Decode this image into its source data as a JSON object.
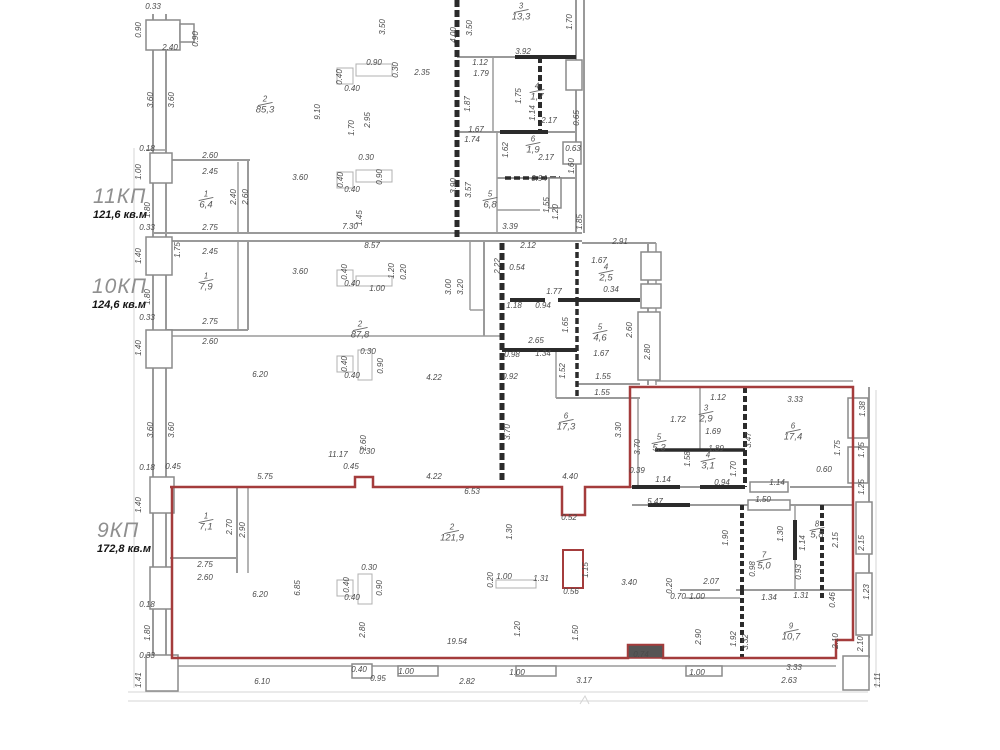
{
  "colors": {
    "unit_outline": "#a43c3c",
    "walls": "#9a9a9a",
    "walls_dark": "#2b2b2b",
    "dim_text": "#4a4a4a"
  },
  "units": [
    {
      "name": "11КП",
      "area": "121,6 кв.м",
      "x": 93,
      "y": 186
    },
    {
      "name": "10КП",
      "area": "124,6 кв.м",
      "x": 92,
      "y": 276
    },
    {
      "name": "9КП",
      "area": "172,8 кв.м",
      "x": 97,
      "y": 520
    }
  ],
  "rooms": [
    {
      "num": "2",
      "area": "85,3",
      "x": 265,
      "y": 105
    },
    {
      "num": "1",
      "area": "6,4",
      "x": 206,
      "y": 200
    },
    {
      "num": "3",
      "area": "13,3",
      "x": 521,
      "y": 12
    },
    {
      "num": "4",
      "area": "1,7",
      "x": 537,
      "y": 92
    },
    {
      "num": "5",
      "area": "6,8",
      "x": 490,
      "y": 200
    },
    {
      "num": "6",
      "area": "1,9",
      "x": 533,
      "y": 145
    },
    {
      "num": "1",
      "area": "7,9",
      "x": 206,
      "y": 282
    },
    {
      "num": "2",
      "area": "87,8",
      "x": 360,
      "y": 330
    },
    {
      "num": "4",
      "area": "2,5",
      "x": 606,
      "y": 273
    },
    {
      "num": "5",
      "area": "4,6",
      "x": 600,
      "y": 333
    },
    {
      "num": "6",
      "area": "17,3",
      "x": 566,
      "y": 422
    },
    {
      "num": "3",
      "area": "2,9",
      "x": 706,
      "y": 414
    },
    {
      "num": "5",
      "area": "5,3",
      "x": 659,
      "y": 443
    },
    {
      "num": "4",
      "area": "3,1",
      "x": 708,
      "y": 461
    },
    {
      "num": "6",
      "area": "17,4",
      "x": 793,
      "y": 432
    },
    {
      "num": "1",
      "area": "7,1",
      "x": 206,
      "y": 522
    },
    {
      "num": "2",
      "area": "121,9",
      "x": 452,
      "y": 533
    },
    {
      "num": "7",
      "area": "5,0",
      "x": 764,
      "y": 561
    },
    {
      "num": "8",
      "area": "5,8",
      "x": 817,
      "y": 530
    },
    {
      "num": "9",
      "area": "10,7",
      "x": 791,
      "y": 632
    }
  ],
  "dimensions": [
    {
      "t": "0.33",
      "x": 153,
      "y": 7
    },
    {
      "t": "0.90",
      "x": 139,
      "y": 30,
      "v": 1
    },
    {
      "t": "0.90",
      "x": 196,
      "y": 39,
      "v": 1
    },
    {
      "t": "2.40",
      "x": 170,
      "y": 48
    },
    {
      "t": "3.60",
      "x": 151,
      "y": 100,
      "v": 1
    },
    {
      "t": "3.60",
      "x": 172,
      "y": 100,
      "v": 1
    },
    {
      "t": "0.18",
      "x": 147,
      "y": 149
    },
    {
      "t": "1.00",
      "x": 139,
      "y": 172,
      "v": 1
    },
    {
      "t": "2.60",
      "x": 210,
      "y": 156
    },
    {
      "t": "2.45",
      "x": 210,
      "y": 172
    },
    {
      "t": "1.80",
      "x": 148,
      "y": 210,
      "v": 1
    },
    {
      "t": "2.40",
      "x": 234,
      "y": 197,
      "v": 1
    },
    {
      "t": "2.60",
      "x": 246,
      "y": 197,
      "v": 1
    },
    {
      "t": "3.60",
      "x": 300,
      "y": 178
    },
    {
      "t": "0.33",
      "x": 147,
      "y": 228
    },
    {
      "t": "2.75",
      "x": 210,
      "y": 228
    },
    {
      "t": "7.30",
      "x": 350,
      "y": 227
    },
    {
      "t": "1.40",
      "x": 139,
      "y": 256,
      "v": 1
    },
    {
      "t": "1.75",
      "x": 178,
      "y": 250,
      "v": 1
    },
    {
      "t": "2.45",
      "x": 210,
      "y": 252
    },
    {
      "t": "8.57",
      "x": 372,
      "y": 246
    },
    {
      "t": "3.60",
      "x": 300,
      "y": 272
    },
    {
      "t": "1.80",
      "x": 148,
      "y": 297,
      "v": 1
    },
    {
      "t": "0.33",
      "x": 147,
      "y": 318
    },
    {
      "t": "2.75",
      "x": 210,
      "y": 322
    },
    {
      "t": "2.60",
      "x": 210,
      "y": 342
    },
    {
      "t": "1.40",
      "x": 139,
      "y": 348,
      "v": 1
    },
    {
      "t": "3.60",
      "x": 151,
      "y": 430,
      "v": 1
    },
    {
      "t": "3.60",
      "x": 172,
      "y": 430,
      "v": 1
    },
    {
      "t": "6.20",
      "x": 260,
      "y": 375
    },
    {
      "t": "0.18",
      "x": 147,
      "y": 468
    },
    {
      "t": "0.45",
      "x": 173,
      "y": 467
    },
    {
      "t": "5.75",
      "x": 265,
      "y": 477
    },
    {
      "t": "1.40",
      "x": 139,
      "y": 505,
      "v": 1
    },
    {
      "t": "2.75",
      "x": 205,
      "y": 565
    },
    {
      "t": "2.60",
      "x": 205,
      "y": 578
    },
    {
      "t": "6.20",
      "x": 260,
      "y": 595
    },
    {
      "t": "6.85",
      "x": 298,
      "y": 588,
      "v": 1
    },
    {
      "t": "0.18",
      "x": 147,
      "y": 605
    },
    {
      "t": "1.80",
      "x": 148,
      "y": 633,
      "v": 1
    },
    {
      "t": "0.33",
      "x": 147,
      "y": 656
    },
    {
      "t": "1.41",
      "x": 139,
      "y": 680,
      "v": 1
    },
    {
      "t": "6.10",
      "x": 262,
      "y": 682
    },
    {
      "t": "3.50",
      "x": 383,
      "y": 27,
      "v": 1
    },
    {
      "t": "0.40",
      "x": 340,
      "y": 77,
      "v": 1
    },
    {
      "t": "0.90",
      "x": 374,
      "y": 63
    },
    {
      "t": "0.40",
      "x": 352,
      "y": 89
    },
    {
      "t": "0.30",
      "x": 396,
      "y": 70,
      "v": 1
    },
    {
      "t": "2.35",
      "x": 422,
      "y": 73
    },
    {
      "t": "9.10",
      "x": 318,
      "y": 112,
      "v": 1
    },
    {
      "t": "1.70",
      "x": 352,
      "y": 128,
      "v": 1
    },
    {
      "t": "2.95",
      "x": 368,
      "y": 120,
      "v": 1
    },
    {
      "t": "0.30",
      "x": 366,
      "y": 158
    },
    {
      "t": "0.40",
      "x": 341,
      "y": 180,
      "v": 1
    },
    {
      "t": "0.90",
      "x": 380,
      "y": 177,
      "v": 1
    },
    {
      "t": "0.40",
      "x": 352,
      "y": 190
    },
    {
      "t": "1.45",
      "x": 360,
      "y": 218,
      "v": 1
    },
    {
      "t": "4.00",
      "x": 454,
      "y": 35,
      "v": 1
    },
    {
      "t": "3.50",
      "x": 470,
      "y": 28,
      "v": 1
    },
    {
      "t": "1.70",
      "x": 570,
      "y": 22,
      "v": 1
    },
    {
      "t": "3.92",
      "x": 523,
      "y": 52
    },
    {
      "t": "1.12",
      "x": 480,
      "y": 63
    },
    {
      "t": "1.79",
      "x": 481,
      "y": 74
    },
    {
      "t": "1.75",
      "x": 519,
      "y": 96,
      "v": 1
    },
    {
      "t": "1.14",
      "x": 533,
      "y": 113,
      "v": 1
    },
    {
      "t": "1.87",
      "x": 468,
      "y": 104,
      "v": 1
    },
    {
      "t": "2.17",
      "x": 549,
      "y": 121
    },
    {
      "t": "1.67",
      "x": 476,
      "y": 130
    },
    {
      "t": "1.74",
      "x": 472,
      "y": 140
    },
    {
      "t": "0.65",
      "x": 577,
      "y": 118,
      "v": 1
    },
    {
      "t": "1.62",
      "x": 506,
      "y": 150,
      "v": 1
    },
    {
      "t": "2.17",
      "x": 546,
      "y": 158
    },
    {
      "t": "0.63",
      "x": 573,
      "y": 149
    },
    {
      "t": "1.60",
      "x": 572,
      "y": 166,
      "v": 1
    },
    {
      "t": "0.94",
      "x": 539,
      "y": 179
    },
    {
      "t": "3.90",
      "x": 454,
      "y": 186,
      "v": 1
    },
    {
      "t": "3.57",
      "x": 469,
      "y": 190,
      "v": 1
    },
    {
      "t": "1.55",
      "x": 547,
      "y": 205,
      "v": 1
    },
    {
      "t": "1.20",
      "x": 556,
      "y": 212,
      "v": 1
    },
    {
      "t": "1.85",
      "x": 580,
      "y": 222,
      "v": 1
    },
    {
      "t": "3.39",
      "x": 510,
      "y": 227
    },
    {
      "t": "2.91",
      "x": 620,
      "y": 242
    },
    {
      "t": "0.40",
      "x": 345,
      "y": 272,
      "v": 1
    },
    {
      "t": "0.40",
      "x": 352,
      "y": 284
    },
    {
      "t": "1.00",
      "x": 377,
      "y": 289
    },
    {
      "t": "1.20",
      "x": 392,
      "y": 271,
      "v": 1
    },
    {
      "t": "0.20",
      "x": 404,
      "y": 272,
      "v": 1
    },
    {
      "t": "3.00",
      "x": 449,
      "y": 287,
      "v": 1
    },
    {
      "t": "3.20",
      "x": 461,
      "y": 287,
      "v": 1
    },
    {
      "t": "2.12",
      "x": 528,
      "y": 246
    },
    {
      "t": "2.22",
      "x": 498,
      "y": 266,
      "v": 1
    },
    {
      "t": "0.54",
      "x": 517,
      "y": 268
    },
    {
      "t": "1.67",
      "x": 599,
      "y": 261
    },
    {
      "t": "0.34",
      "x": 611,
      "y": 290
    },
    {
      "t": "1.77",
      "x": 554,
      "y": 292
    },
    {
      "t": "1.18",
      "x": 514,
      "y": 306
    },
    {
      "t": "0.94",
      "x": 543,
      "y": 306
    },
    {
      "t": "1.65",
      "x": 566,
      "y": 325,
      "v": 1
    },
    {
      "t": "2.65",
      "x": 536,
      "y": 341
    },
    {
      "t": "1.34",
      "x": 543,
      "y": 354
    },
    {
      "t": "0.98",
      "x": 512,
      "y": 355
    },
    {
      "t": "0.92",
      "x": 510,
      "y": 377
    },
    {
      "t": "1.52",
      "x": 563,
      "y": 371,
      "v": 1
    },
    {
      "t": "1.67",
      "x": 601,
      "y": 354
    },
    {
      "t": "1.55",
      "x": 603,
      "y": 377
    },
    {
      "t": "1.55",
      "x": 602,
      "y": 393
    },
    {
      "t": "2.60",
      "x": 630,
      "y": 330,
      "v": 1
    },
    {
      "t": "2.80",
      "x": 648,
      "y": 352,
      "v": 1
    },
    {
      "t": "0.30",
      "x": 368,
      "y": 352
    },
    {
      "t": "0.40",
      "x": 345,
      "y": 364,
      "v": 1
    },
    {
      "t": "0.90",
      "x": 381,
      "y": 366,
      "v": 1
    },
    {
      "t": "0.40",
      "x": 352,
      "y": 376
    },
    {
      "t": "4.22",
      "x": 434,
      "y": 378
    },
    {
      "t": "11.17",
      "x": 338,
      "y": 455
    },
    {
      "t": "2.60",
      "x": 364,
      "y": 443,
      "v": 1
    },
    {
      "t": "0.30",
      "x": 367,
      "y": 452
    },
    {
      "t": "0.45",
      "x": 351,
      "y": 467
    },
    {
      "t": "3.70",
      "x": 508,
      "y": 432,
      "v": 1
    },
    {
      "t": "3.30",
      "x": 619,
      "y": 430,
      "v": 1
    },
    {
      "t": "4.22",
      "x": 434,
      "y": 477
    },
    {
      "t": "4.40",
      "x": 570,
      "y": 477
    },
    {
      "t": "6.53",
      "x": 472,
      "y": 492
    },
    {
      "t": "1.12",
      "x": 718,
      "y": 398
    },
    {
      "t": "3.33",
      "x": 795,
      "y": 400
    },
    {
      "t": "1.38",
      "x": 863,
      "y": 409,
      "v": 1
    },
    {
      "t": "1.72",
      "x": 678,
      "y": 420
    },
    {
      "t": "3.70",
      "x": 638,
      "y": 447,
      "v": 1
    },
    {
      "t": "1.69",
      "x": 713,
      "y": 432
    },
    {
      "t": "1.89",
      "x": 716,
      "y": 449
    },
    {
      "t": "3.47",
      "x": 749,
      "y": 440,
      "v": 1
    },
    {
      "t": "1.75",
      "x": 838,
      "y": 448,
      "v": 1
    },
    {
      "t": "1.75",
      "x": 862,
      "y": 450,
      "v": 1
    },
    {
      "t": "1.58",
      "x": 688,
      "y": 459,
      "v": 1
    },
    {
      "t": "0.39",
      "x": 637,
      "y": 471
    },
    {
      "t": "1.14",
      "x": 663,
      "y": 480
    },
    {
      "t": "0.94",
      "x": 722,
      "y": 483
    },
    {
      "t": "1.70",
      "x": 734,
      "y": 469,
      "v": 1
    },
    {
      "t": "1.14",
      "x": 777,
      "y": 483
    },
    {
      "t": "0.60",
      "x": 824,
      "y": 470
    },
    {
      "t": "1.25",
      "x": 862,
      "y": 487,
      "v": 1
    },
    {
      "t": "5.47",
      "x": 655,
      "y": 502
    },
    {
      "t": "1.50",
      "x": 763,
      "y": 500
    },
    {
      "t": "0.52",
      "x": 569,
      "y": 518
    },
    {
      "t": "2.70",
      "x": 230,
      "y": 527,
      "v": 1
    },
    {
      "t": "2.90",
      "x": 243,
      "y": 530,
      "v": 1
    },
    {
      "t": "1.30",
      "x": 510,
      "y": 532,
      "v": 1
    },
    {
      "t": "1.15",
      "x": 586,
      "y": 570,
      "v": 1
    },
    {
      "t": "0.56",
      "x": 571,
      "y": 592
    },
    {
      "t": "1.00",
      "x": 504,
      "y": 577
    },
    {
      "t": "0.20",
      "x": 491,
      "y": 580,
      "v": 1
    },
    {
      "t": "1.31",
      "x": 541,
      "y": 579
    },
    {
      "t": "3.40",
      "x": 629,
      "y": 583
    },
    {
      "t": "0.20",
      "x": 670,
      "y": 586,
      "v": 1
    },
    {
      "t": "0.70",
      "x": 678,
      "y": 597
    },
    {
      "t": "2.07",
      "x": 711,
      "y": 582
    },
    {
      "t": "1.00",
      "x": 697,
      "y": 597
    },
    {
      "t": "1.34",
      "x": 769,
      "y": 598
    },
    {
      "t": "1.31",
      "x": 801,
      "y": 596
    },
    {
      "t": "0.46",
      "x": 833,
      "y": 600,
      "v": 1
    },
    {
      "t": "1.90",
      "x": 726,
      "y": 538,
      "v": 1
    },
    {
      "t": "1.30",
      "x": 781,
      "y": 534,
      "v": 1
    },
    {
      "t": "1.14",
      "x": 803,
      "y": 543,
      "v": 1
    },
    {
      "t": "0.98",
      "x": 753,
      "y": 569,
      "v": 1
    },
    {
      "t": "0.93",
      "x": 799,
      "y": 572,
      "v": 1
    },
    {
      "t": "2.15",
      "x": 836,
      "y": 540,
      "v": 1
    },
    {
      "t": "2.15",
      "x": 862,
      "y": 543,
      "v": 1
    },
    {
      "t": "1.23",
      "x": 867,
      "y": 592,
      "v": 1
    },
    {
      "t": "2.90",
      "x": 699,
      "y": 637,
      "v": 1
    },
    {
      "t": "1.92",
      "x": 734,
      "y": 639,
      "v": 1
    },
    {
      "t": "3.32",
      "x": 746,
      "y": 642,
      "v": 1
    },
    {
      "t": "2.10",
      "x": 836,
      "y": 641,
      "v": 1
    },
    {
      "t": "2.10",
      "x": 861,
      "y": 644,
      "v": 1
    },
    {
      "t": "3.33",
      "x": 794,
      "y": 668
    },
    {
      "t": "2.63",
      "x": 789,
      "y": 681
    },
    {
      "t": "1.11",
      "x": 878,
      "y": 680,
      "v": 1
    },
    {
      "t": "1.00",
      "x": 697,
      "y": 673
    },
    {
      "t": "0.74",
      "x": 641,
      "y": 655
    },
    {
      "t": "19.54",
      "x": 457,
      "y": 642
    },
    {
      "t": "1.20",
      "x": 518,
      "y": 629,
      "v": 1
    },
    {
      "t": "1.50",
      "x": 576,
      "y": 633,
      "v": 1
    },
    {
      "t": "2.80",
      "x": 363,
      "y": 630,
      "v": 1
    },
    {
      "t": "0.30",
      "x": 369,
      "y": 568
    },
    {
      "t": "0.40",
      "x": 347,
      "y": 585,
      "v": 1
    },
    {
      "t": "0.90",
      "x": 380,
      "y": 588,
      "v": 1
    },
    {
      "t": "0.40",
      "x": 352,
      "y": 598
    },
    {
      "t": "0.40",
      "x": 359,
      "y": 670
    },
    {
      "t": "0.95",
      "x": 378,
      "y": 679
    },
    {
      "t": "1.00",
      "x": 406,
      "y": 672
    },
    {
      "t": "2.82",
      "x": 467,
      "y": 682
    },
    {
      "t": "1.00",
      "x": 517,
      "y": 673
    },
    {
      "t": "3.17",
      "x": 584,
      "y": 681
    }
  ]
}
